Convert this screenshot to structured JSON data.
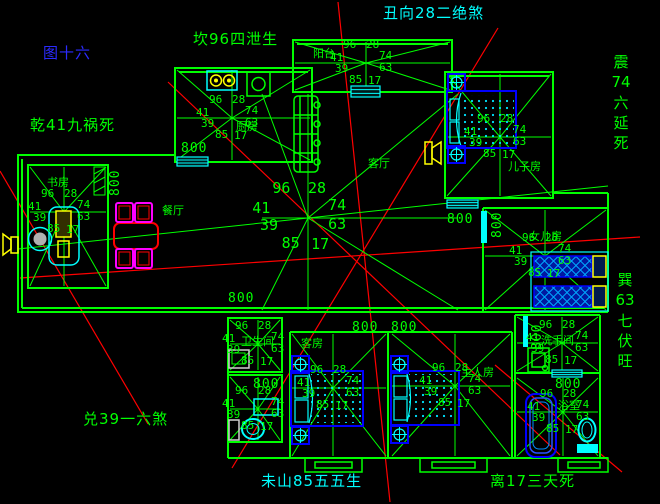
{
  "figure_label": "图十六",
  "direction_labels": {
    "chou": "丑向28二绝煞",
    "kan": "坎96四泄生",
    "qian": "乾41九祸死",
    "zhen": "震\n74\n六\n延\n死",
    "xun": "巽\n63\n七\n伏\n旺",
    "dui": "兑39一六煞",
    "wei": "未山85五五生",
    "li": "离17三天死"
  },
  "rooms": {
    "kitchen": "厨房",
    "balcony": "阳台",
    "son_room": "儿子房",
    "study": "书房",
    "dining": "餐厅",
    "living": "客厅",
    "daughter_room": "女儿房",
    "bathroom": "卫生间",
    "guest_room": "客房",
    "master_room": "主人房",
    "washroom": "洗手间",
    "bath": "浴室"
  },
  "star_numbers": {
    "top_left": "96",
    "top_right": "28",
    "left": "41",
    "right": "74",
    "mid_left": "39",
    "mid_right": "63",
    "bottom_left": "85",
    "bottom_right": "17"
  },
  "dimension_label": "800",
  "colors": {
    "background": "#000000",
    "line_green": "#00ff00",
    "accent_cyan": "#00ffff",
    "accent_red": "#ff0000",
    "accent_blue": "#0000ff",
    "accent_yellow": "#ffff00",
    "accent_magenta": "#ff00ff",
    "figure_blue": "#2b2bff"
  }
}
